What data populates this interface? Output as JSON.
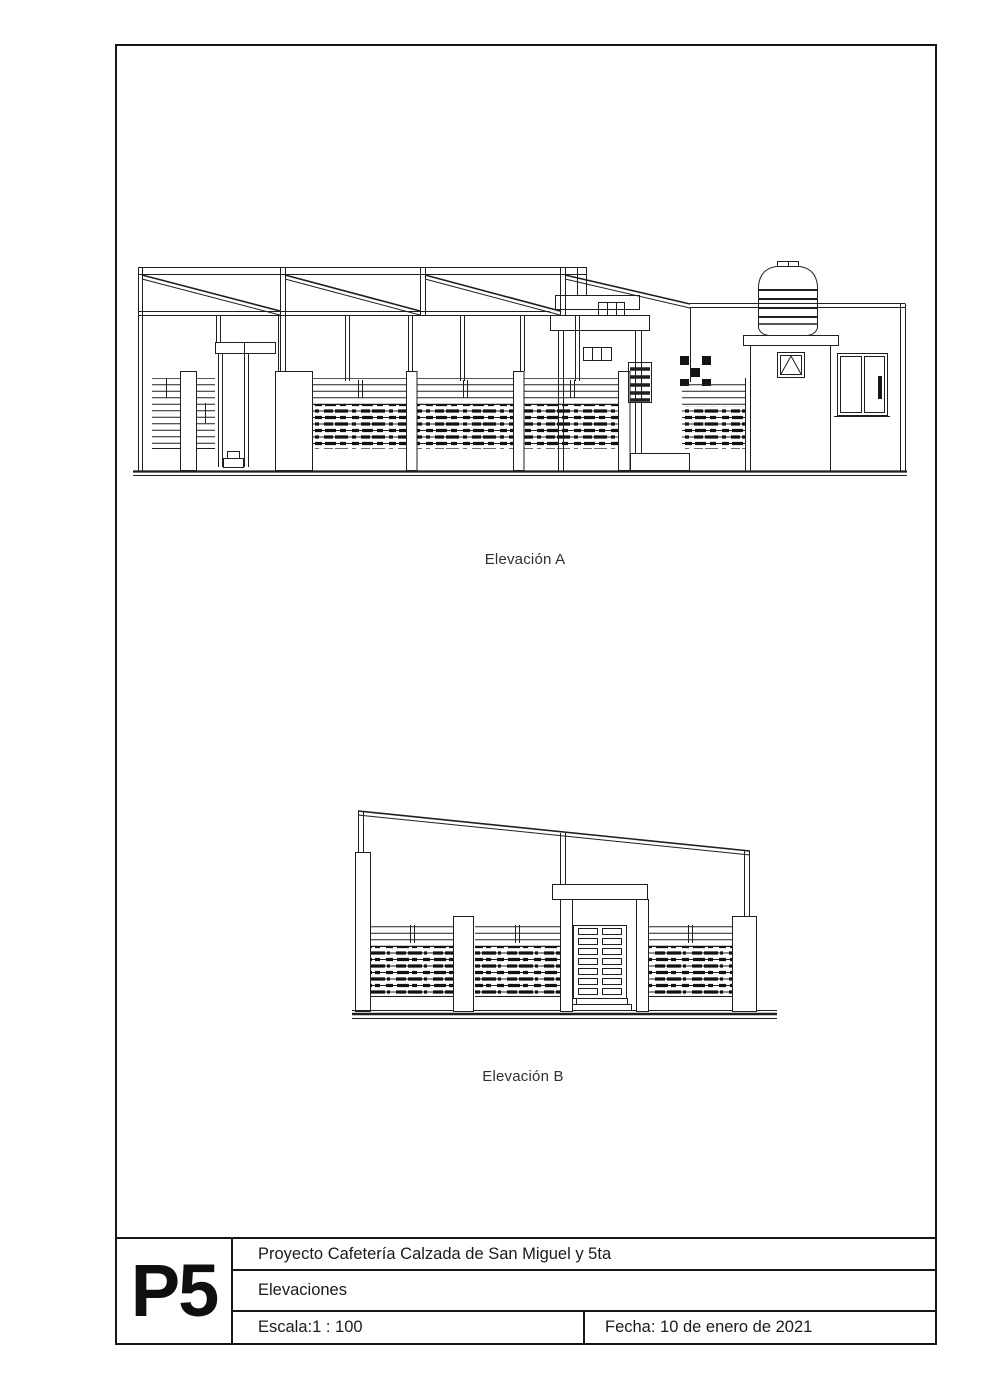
{
  "page": {
    "background": "#ffffff",
    "line_color": "#1f1f1f",
    "text_color": "#1a1a1a"
  },
  "drawings": {
    "elevation_a": {
      "label": "Elevación A"
    },
    "elevation_b": {
      "label": "Elevación B"
    }
  },
  "title_block": {
    "sheet_number": "P5",
    "project": "Proyecto Cafetería Calzada de San Miguel y 5ta",
    "sheet_title": "Elevaciones",
    "scale": "Escala:1 : 100",
    "date": "Fecha: 10 de enero de 2021"
  }
}
